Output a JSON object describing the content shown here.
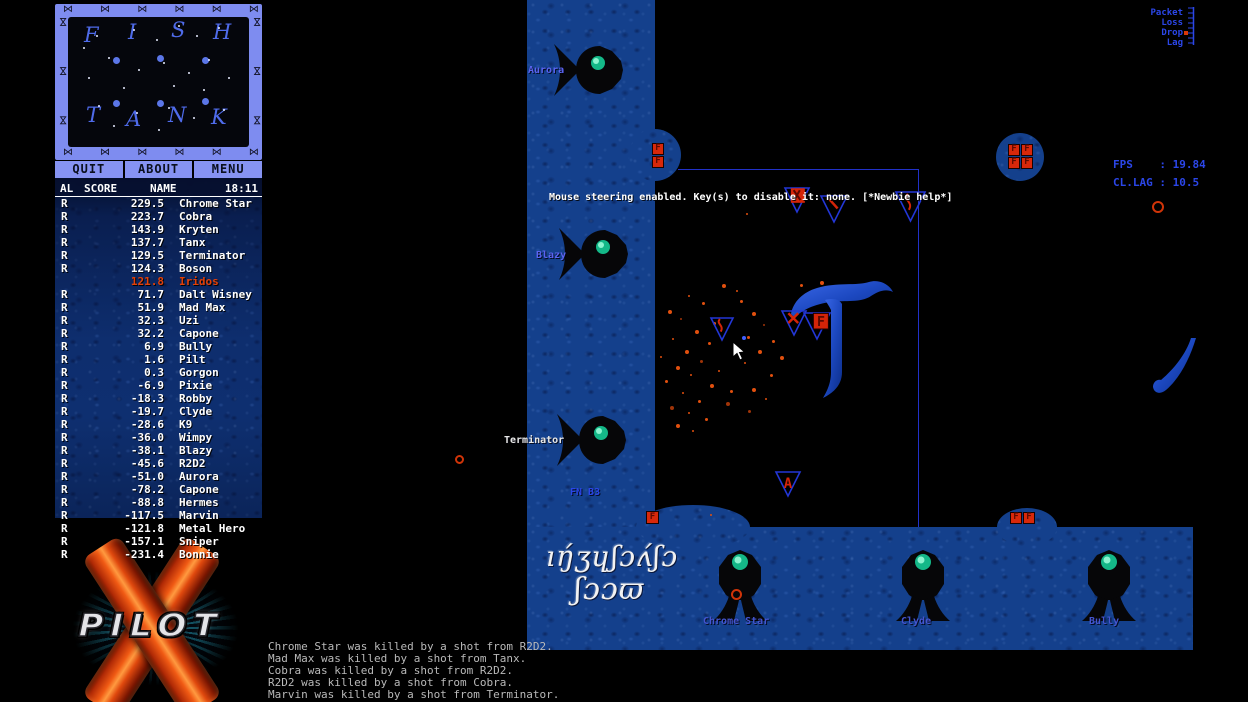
{
  "sidebar": {
    "minimap": {
      "border_glyph": "⋈",
      "letters": [
        {
          "ch": "F",
          "x": 16,
          "y": 6
        },
        {
          "ch": "I",
          "x": 60,
          "y": 3
        },
        {
          "ch": "S",
          "x": 103,
          "y": 1
        },
        {
          "ch": "H",
          "x": 145,
          "y": 3
        },
        {
          "ch": "T",
          "x": 18,
          "y": 86
        },
        {
          "ch": "A",
          "x": 58,
          "y": 90
        },
        {
          "ch": "N",
          "x": 100,
          "y": 86
        },
        {
          "ch": "K",
          "x": 143,
          "y": 88
        }
      ],
      "bumps": [
        [
          45,
          40
        ],
        [
          89,
          38
        ],
        [
          134,
          40
        ],
        [
          45,
          83
        ],
        [
          89,
          83
        ],
        [
          134,
          81
        ]
      ],
      "stars": [
        [
          28,
          18
        ],
        [
          65,
          12
        ],
        [
          88,
          22
        ],
        [
          110,
          8
        ],
        [
          128,
          18
        ],
        [
          150,
          10
        ],
        [
          40,
          40
        ],
        [
          70,
          52
        ],
        [
          95,
          45
        ],
        [
          120,
          55
        ],
        [
          140,
          42
        ],
        [
          20,
          60
        ],
        [
          55,
          70
        ],
        [
          105,
          68
        ],
        [
          135,
          72
        ],
        [
          30,
          88
        ],
        [
          68,
          95
        ],
        [
          100,
          90
        ],
        [
          125,
          100
        ],
        [
          155,
          92
        ],
        [
          45,
          108
        ],
        [
          90,
          112
        ],
        [
          160,
          60
        ],
        [
          15,
          30
        ]
      ]
    },
    "menu_buttons": [
      {
        "label": "QUIT"
      },
      {
        "label": "ABOUT"
      },
      {
        "label": "MENU"
      }
    ],
    "scoreboard": {
      "clock": "18:11",
      "columns": [
        "AL",
        "SCORE",
        "NAME"
      ],
      "rows": [
        {
          "flag": "R",
          "score": "229.5",
          "name": "Chrome Star",
          "highlight": false
        },
        {
          "flag": "R",
          "score": "223.7",
          "name": "Cobra",
          "highlight": false
        },
        {
          "flag": "R",
          "score": "143.9",
          "name": "Kryten",
          "highlight": false
        },
        {
          "flag": "R",
          "score": "137.7",
          "name": "Tanx",
          "highlight": false
        },
        {
          "flag": "R",
          "score": "129.5",
          "name": "Terminator",
          "highlight": false
        },
        {
          "flag": "R",
          "score": "124.3",
          "name": "Boson",
          "highlight": false
        },
        {
          "flag": "",
          "score": "121.8",
          "name": "Iridos",
          "highlight": true
        },
        {
          "flag": "R",
          "score": "71.7",
          "name": "Dalt Wisney",
          "highlight": false
        },
        {
          "flag": "R",
          "score": "51.9",
          "name": "Mad Max",
          "highlight": false
        },
        {
          "flag": "R",
          "score": "32.3",
          "name": "Uzi",
          "highlight": false
        },
        {
          "flag": "R",
          "score": "32.2",
          "name": "Capone",
          "highlight": false
        },
        {
          "flag": "R",
          "score": "6.9",
          "name": "Bully",
          "highlight": false
        },
        {
          "flag": "R",
          "score": "1.6",
          "name": "Pilt",
          "highlight": false
        },
        {
          "flag": "R",
          "score": "0.3",
          "name": "Gorgon",
          "highlight": false
        },
        {
          "flag": "R",
          "score": "-6.9",
          "name": "Pixie",
          "highlight": false
        },
        {
          "flag": "R",
          "score": "-18.3",
          "name": "Robby",
          "highlight": false
        },
        {
          "flag": "R",
          "score": "-19.7",
          "name": "Clyde",
          "highlight": false
        },
        {
          "flag": "R",
          "score": "-28.6",
          "name": "K9",
          "highlight": false
        },
        {
          "flag": "R",
          "score": "-36.0",
          "name": "Wimpy",
          "highlight": false
        },
        {
          "flag": "R",
          "score": "-38.1",
          "name": "Blazy",
          "highlight": false
        },
        {
          "flag": "R",
          "score": "-45.6",
          "name": "R2D2",
          "highlight": false
        },
        {
          "flag": "R",
          "score": "-51.0",
          "name": "Aurora",
          "highlight": false
        },
        {
          "flag": "R",
          "score": "-78.2",
          "name": "Capone",
          "highlight": false
        },
        {
          "flag": "R",
          "score": "-88.8",
          "name": "Hermes",
          "highlight": false
        },
        {
          "flag": "R",
          "score": "-117.5",
          "name": "Marvin",
          "highlight": false
        },
        {
          "flag": "R",
          "score": "-121.8",
          "name": "Metal Hero",
          "highlight": false
        },
        {
          "flag": "R",
          "score": "-157.1",
          "name": "Sniper",
          "highlight": false
        },
        {
          "flag": "R",
          "score": "-231.4",
          "name": "Bonnie",
          "highlight": false
        }
      ]
    },
    "logo_text": "PILOT"
  },
  "killfeed": {
    "lines": [
      "Chrome Star was killed by a shot from R2D2.",
      "Mad Max was killed by a shot from Tanx.",
      "Cobra was killed by a shot from R2D2.",
      "R2D2 was killed by a shot from Cobra.",
      "Marvin was killed by a shot from Terminator."
    ]
  },
  "hud": {
    "message": "Mouse steering enabled. Key(s) to disable it: none. [*Newbie help*]",
    "fps": "FPS    : 19.84",
    "cl_lag": "CL.LAG : 10.5",
    "packet_labels": [
      "Packet",
      "Loss",
      "Drop",
      "Lag"
    ]
  },
  "game": {
    "fuel_label": "F",
    "base_label": "FN B3",
    "inscription_line1": "ıŋ́ʒɥʃɔʌ́ʃɔ",
    "inscription_line2": "ʃɔɔϖ",
    "wall_fish": [
      {
        "x": 552,
        "y": 42,
        "label": "Aurora",
        "lx": 528,
        "ly": 65,
        "color": "#5a64f0"
      },
      {
        "x": 557,
        "y": 226,
        "label": "Blazy",
        "lx": 536,
        "ly": 250,
        "color": "#5a64f0"
      },
      {
        "x": 555,
        "y": 412,
        "label": "Terminator",
        "lx": 504,
        "ly": 435,
        "color": "#e8e8e8"
      }
    ],
    "bottom_ships": [
      {
        "x": 712,
        "y": 548,
        "label": "Chrome Star",
        "lx": 703,
        "ly": 616,
        "ring": [
          731,
          589
        ]
      },
      {
        "x": 895,
        "y": 548,
        "label": "Clyde",
        "lx": 901,
        "ly": 616
      },
      {
        "x": 1081,
        "y": 548,
        "label": "Bully",
        "lx": 1089,
        "ly": 616
      }
    ],
    "ships": [
      {
        "x": 783,
        "y": 186,
        "s": 28,
        "mark": "box"
      },
      {
        "x": 819,
        "y": 194,
        "s": 30,
        "mark": "slash"
      },
      {
        "x": 894,
        "y": 190,
        "s": 33,
        "mark": "squiggle"
      },
      {
        "x": 709,
        "y": 316,
        "s": 26,
        "mark": "squiggle"
      },
      {
        "x": 780,
        "y": 309,
        "s": 28,
        "mark": "x"
      },
      {
        "x": 802,
        "y": 311,
        "s": 30,
        "mark": "fbox"
      },
      {
        "x": 774,
        "y": 470,
        "s": 28,
        "mark": "a"
      }
    ],
    "fuel_boxes": [
      [
        652,
        143,
        12
      ],
      [
        652,
        156,
        12
      ],
      [
        1008,
        144,
        12
      ],
      [
        1021,
        144,
        12
      ],
      [
        1008,
        157,
        12
      ],
      [
        1021,
        157,
        12
      ],
      [
        646,
        511,
        13
      ],
      [
        1010,
        512,
        12
      ],
      [
        1023,
        512,
        12
      ]
    ],
    "sparks": [
      [
        688,
        295
      ],
      [
        702,
        302
      ],
      [
        668,
        310
      ],
      [
        680,
        318
      ],
      [
        713,
        322
      ],
      [
        695,
        330
      ],
      [
        672,
        338
      ],
      [
        708,
        342
      ],
      [
        685,
        350
      ],
      [
        660,
        356
      ],
      [
        700,
        360
      ],
      [
        676,
        366
      ],
      [
        690,
        374
      ],
      [
        665,
        380
      ],
      [
        710,
        384
      ],
      [
        682,
        392
      ],
      [
        698,
        400
      ],
      [
        670,
        406
      ],
      [
        688,
        412
      ],
      [
        705,
        418
      ],
      [
        676,
        424
      ],
      [
        692,
        430
      ],
      [
        740,
        300
      ],
      [
        752,
        312
      ],
      [
        763,
        324
      ],
      [
        747,
        336
      ],
      [
        758,
        350
      ],
      [
        744,
        362
      ],
      [
        770,
        374
      ],
      [
        752,
        388
      ],
      [
        765,
        398
      ],
      [
        748,
        410
      ],
      [
        722,
        284
      ],
      [
        736,
        290
      ],
      [
        800,
        284
      ],
      [
        820,
        281
      ],
      [
        746,
        213
      ],
      [
        730,
        390
      ],
      [
        726,
        402
      ],
      [
        718,
        370
      ],
      [
        772,
        340
      ],
      [
        780,
        356
      ],
      [
        710,
        514
      ]
    ],
    "balls": [
      [
        1152,
        201,
        12
      ],
      [
        455,
        455,
        9
      ]
    ],
    "bullet": [
      742,
      336
    ]
  }
}
